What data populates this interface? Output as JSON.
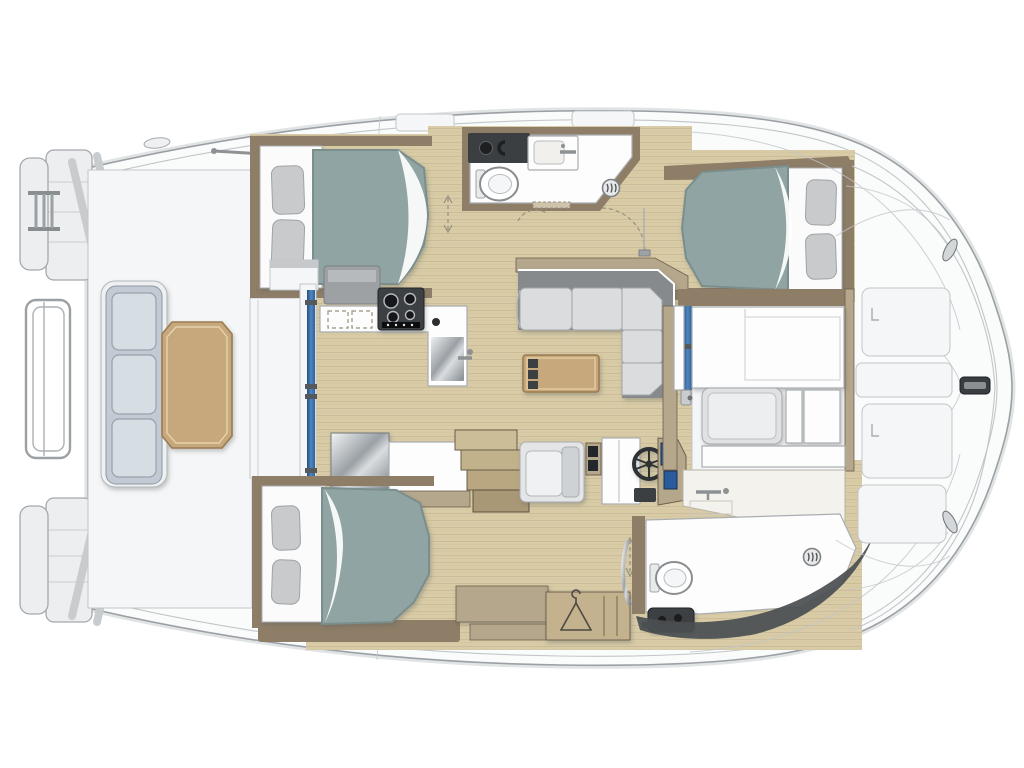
{
  "image_type": "yacht-floor-plan",
  "boat": {
    "view": "top-down deck plan",
    "orientation": "bow-right-stern-left",
    "style": "catamaran charter yacht interior layout"
  },
  "palette": {
    "bg": "#ffffff",
    "hull_fill": "#fafbfb",
    "hull_line": "#9aa0a4",
    "shadow_soft": "#c9cdd0",
    "deck_white": "#f5f6f7",
    "deck_line": "#c2c6c9",
    "wood_floor": "#d8cba6",
    "wood_grain": "#b6a784",
    "wall_brown": "#8e7d67",
    "wall_tan": "#b5a78c",
    "trim_dark": "#6e604d",
    "mattress": "#90a4a3",
    "mattress_edge": "#7a8e8d",
    "bed_base": "#fbfbfb",
    "pillow": "#c8cacc",
    "cushion_blue": "#c2cbd4",
    "cushion_face": "#d6dde3",
    "sofa_cushion": "#dadcde",
    "sofa_back": "#868a8d",
    "table_wood": "#c6a87c",
    "table_edge": "#9a7b50",
    "dark_fixture": "#3c3f42",
    "steel": "#9ea3a7",
    "window_blue": "#2f6197",
    "screen_blue": "#2a5c9d",
    "fixture_white": "#fdfdfd",
    "line_gray": "#a9adb0",
    "dark_band": "#4a4e51"
  },
  "areas": {
    "aft_deck": {
      "name": "aft-deck-lounge",
      "fixtures": [
        "swim-ladder",
        "stern-railing",
        "transom-platforms",
        "bench-seat-3-cushions",
        "wood-cockpit-table"
      ]
    },
    "port_aft_cabin": {
      "name": "double-cabin",
      "fixtures": [
        "double-bed",
        "two-pillows",
        "folded-sheet"
      ]
    },
    "forward_head": {
      "name": "bathroom",
      "fixtures": [
        "toilet",
        "washbasin",
        "vanity-counter",
        "shower-drain",
        "door-threshold"
      ]
    },
    "starboard_cabin": {
      "name": "double-cabin",
      "fixtures": [
        "double-bed",
        "two-pillows",
        "folded-sheet",
        "door-swing"
      ]
    },
    "galley": {
      "name": "galley",
      "fixtures": [
        "gas-hob-4-burners",
        "sink",
        "counter",
        "drawers",
        "refrigerator"
      ]
    },
    "salon": {
      "name": "salon",
      "fixtures": [
        "l-shaped-sofa",
        "coffee-table",
        "window-front"
      ]
    },
    "nav_station": {
      "name": "helm-station",
      "fixtures": [
        "navigator-seat",
        "steering-wheel",
        "instrument-screens",
        "companionway-steps"
      ]
    },
    "forward_cockpit": {
      "name": "cockpit-dinette",
      "fixtures": [
        "white-table",
        "bench-cushion",
        "wet-bar-sink",
        "sliding-door-glass"
      ]
    },
    "lower_cabin": {
      "name": "double-cabin",
      "fixtures": [
        "double-bed",
        "two-pillows",
        "wardrobe-with-hanger",
        "cabinets"
      ]
    },
    "lower_head": {
      "name": "bathroom",
      "fixtures": [
        "toilet",
        "shower-floor",
        "shower-drain",
        "grab-rail",
        "seacock-unit"
      ]
    },
    "bow_deck": {
      "name": "foredeck",
      "fixtures": [
        "deck-hatches",
        "anchor-cleat",
        "mooring-fittings",
        "moulding-seams"
      ]
    }
  }
}
